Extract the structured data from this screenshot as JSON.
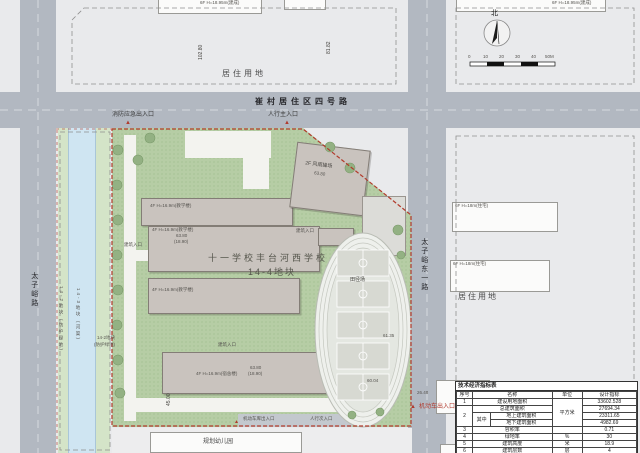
{
  "site": {
    "title1": "十一学校丰台河西学校",
    "title2": "14-4地块"
  },
  "roads": {
    "top": "崔村居住区四号路",
    "left": "太子峪路",
    "right": "太子峪东一路"
  },
  "landuse": {
    "top": "居住用地",
    "right": "居住用地"
  },
  "strips": {
    "canal": "14-3地块（河渠）",
    "green": "14-2地块（防护绿地）",
    "inner1": "14-2地块",
    "inner2": "(防护绿地)"
  },
  "entrances": {
    "fire": "消防应急出入口",
    "main": "人行主入口",
    "vehicle": "机动车出入口",
    "garage": "机动车库出入口",
    "secondary": "人行次入口",
    "marker": "▲"
  },
  "buildings": {
    "teach": "4F H=16.9m(教学楼)",
    "dorm": "4F H=16.9m(宿舍楼)",
    "gym": "2F 风雨操场",
    "gym_elev": "63.80",
    "elev": "63.80",
    "elev_h": "(18.90)",
    "entry": "建筑入口",
    "kindergarten": "规划幼儿园",
    "res_built": "6F H=18.95m(建成)",
    "res_right": "6F H=18m(住宅)"
  },
  "sports": {
    "track": "田径场",
    "elev1": "61.35",
    "elev2": "60.04"
  },
  "dims": {
    "a": "102.80",
    "b": "81.82",
    "c": "45.00",
    "d": "26.48"
  },
  "compass": {
    "label": "北"
  },
  "scalebar": {
    "ticks": [
      "0",
      "10",
      "20",
      "30",
      "40",
      "50M"
    ]
  },
  "colors": {
    "boundary": "#b23b2c",
    "site_green": "#b6cda5",
    "road": "#b2b8c1",
    "canal": "#cfe5f2"
  },
  "table": {
    "title": "技术经济指标表",
    "h_no": "序号",
    "h_name": "名称",
    "h_unit": "单位",
    "h_value": "设计指标",
    "r1_no": "1",
    "r1_name": "建设用地面积",
    "r1_value": "33602.528",
    "unit_sqm": "平方米",
    "r2_no": "2",
    "r2_name": "总建筑面积",
    "r2_value": "27694.34",
    "qizhong": "其中",
    "r3_name": "地上建筑面积",
    "r3_value": "23311.65",
    "r4_name": "地下建筑面积",
    "r4_value": "4982.69",
    "r5_no": "3",
    "r5_name": "容积率",
    "r5_unit": "",
    "r5_value": "0.71",
    "r6_no": "4",
    "r6_name": "绿地率",
    "r6_unit": "%",
    "r6_value": "30",
    "r7_no": "5",
    "r7_name": "建筑高度",
    "r7_unit": "米",
    "r7_value": "18.9",
    "r8_no": "6",
    "r8_name": "建筑层数",
    "r8_unit": "层",
    "r8_value": "4"
  }
}
